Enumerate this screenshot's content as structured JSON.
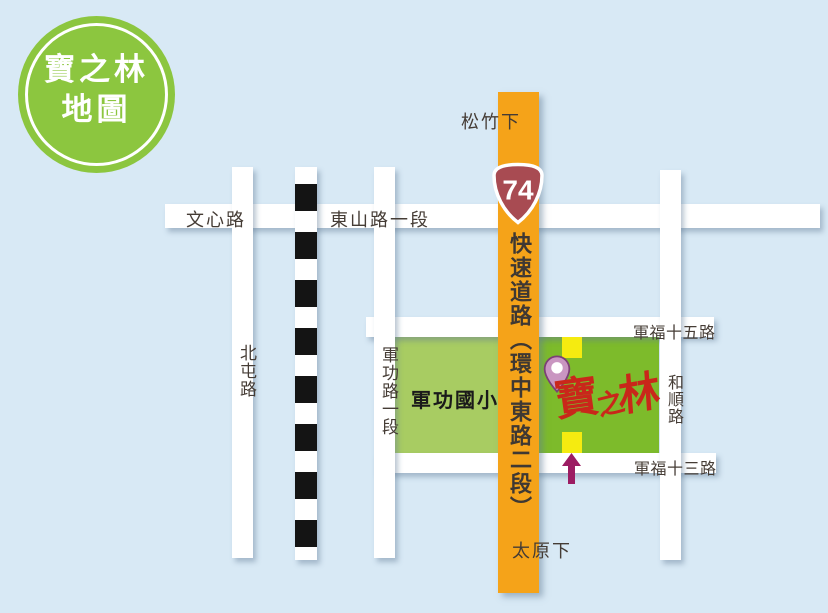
{
  "title_badge": {
    "line1": "寶之林",
    "line2": "地圖"
  },
  "expressway": {
    "shield_number": "74",
    "name_vertical": "快速道路（環中東路二段）",
    "exit_north": "松竹下",
    "exit_south": "太原下"
  },
  "road_labels": {
    "wenxin": "文心路",
    "dongshan_sec1": "東山路一段",
    "beitun": "北屯路",
    "jungong_sec1": "軍功路一段",
    "heshun": "和順路",
    "junfu_15": "軍福十五路",
    "junfu_13": "軍福十三路"
  },
  "places": {
    "school": "軍功國小",
    "store_logo_chars": [
      "寶",
      "之",
      "林"
    ]
  },
  "colors": {
    "background": "#D8E9F5",
    "badge_green": "#8CC63F",
    "expressway_orange": "#F5A319",
    "shield_maroon": "#A84B52",
    "school_block_green": "#A8CC62",
    "store_block_green": "#7DBB2B",
    "entrance_yellow": "#F5EB10",
    "logo_red": "#C9271A",
    "pin_mauve": "#C996C1",
    "pin_outline_purple": "#7C4076",
    "arrow_magenta": "#9C1C62",
    "road_white": "#FFFFFF",
    "railway_black": "#141414",
    "label_dark": "#453C35"
  }
}
